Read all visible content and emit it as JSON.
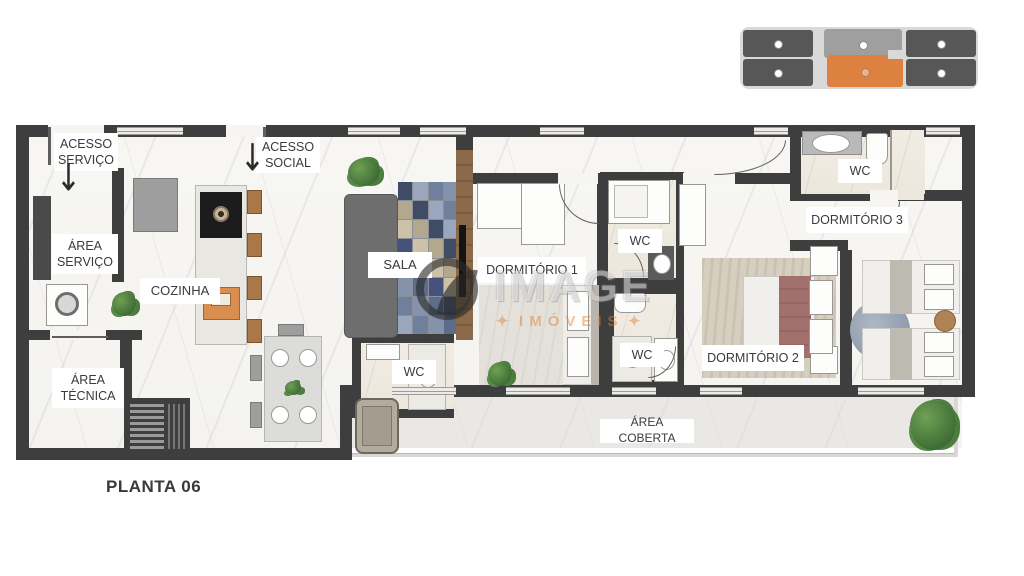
{
  "title": {
    "plan_name": "PLANTA 06"
  },
  "labels": {
    "acesso_servico": "ACESSO SERVIÇO",
    "acesso_social": "ACESSO SOCIAL",
    "area_servico": "ÁREA SERVIÇO",
    "area_tecnica": "ÁREA TÉCNICA",
    "cozinha": "COZINHA",
    "sala": "SALA",
    "wc": "WC",
    "dormitorio_1": "DORMITÓRIO 1",
    "dormitorio_2": "DORMITÓRIO 2",
    "dormitorio_3": "DORMITÓRIO 3",
    "area_coberta": "ÁREA COBERTA",
    "arrow_down": "↓"
  },
  "watermark": {
    "brand": "IMAGE",
    "sub": "IMÓVEIS",
    "star": "✦"
  },
  "key_plan": {
    "bar_color": "#d9d9d9",
    "corner_unit_color": "#575757",
    "top_middle_unit_color": "#9f9f9f",
    "highlighted_unit_color": "#dd8140"
  },
  "rug": {
    "palette": [
      "#3f4c66",
      "#8492aa",
      "#cdc2a7",
      "#9aa6bb",
      "#5d6c8a",
      "#b3a88e",
      "#6f7f9c",
      "#46527c"
    ]
  },
  "colors": {
    "wall": "#3e3e3e",
    "floor": "#f6f5f2",
    "wood": "#8a6a4a",
    "accent": "#dd8140"
  }
}
